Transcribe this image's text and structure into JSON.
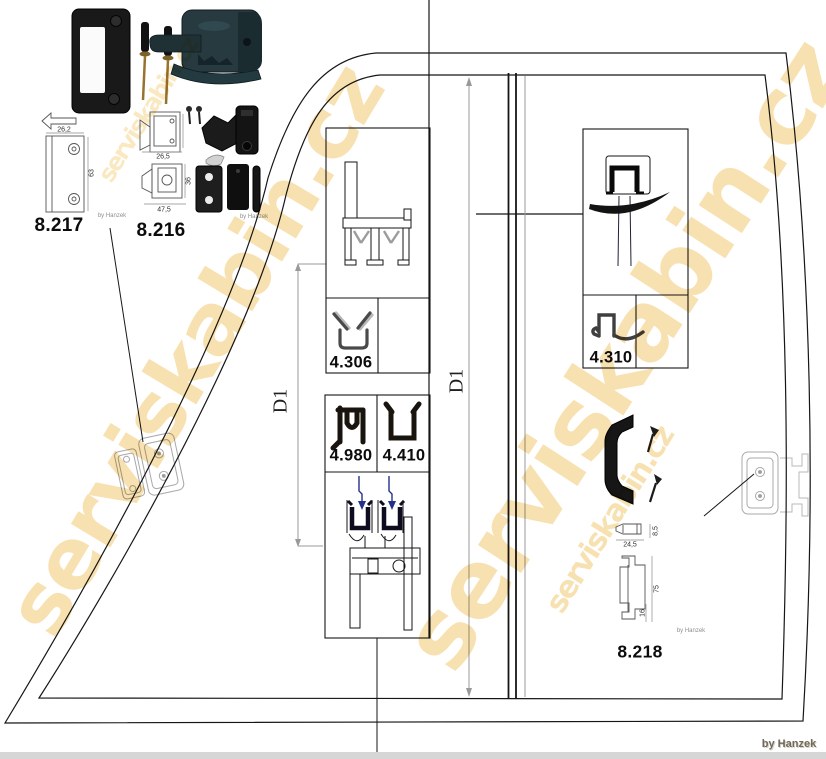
{
  "watermark": {
    "text": "serviskabin.cz",
    "color": "#f2c463"
  },
  "credits": {
    "main": "by Hanzek",
    "micro": "by Hanzek"
  },
  "labels": {
    "p8217": "8.217",
    "p8216": "8.216",
    "p8218": "8.218",
    "p4306": "4.306",
    "p4980": "4.980",
    "p4410": "4.410",
    "p4310": "4.310"
  },
  "dimension_labels": {
    "d1_left": "D1",
    "d1_right": "D1"
  },
  "part_dimensions": {
    "p8217": {
      "width": "26,2",
      "height": "63"
    },
    "p8216": {
      "width_top": "26,5",
      "width_bottom": "47,5",
      "height_bottom": "36"
    },
    "p8218": {
      "depth": "8,5",
      "width": "24,5",
      "height": "75",
      "foot": "16"
    }
  },
  "colors": {
    "line": "#161616",
    "dimension_line": "#999999",
    "glass_blue": "#24308a",
    "seal_dark": "#0d0d1f",
    "watermark_yellow": "#f2c463"
  }
}
